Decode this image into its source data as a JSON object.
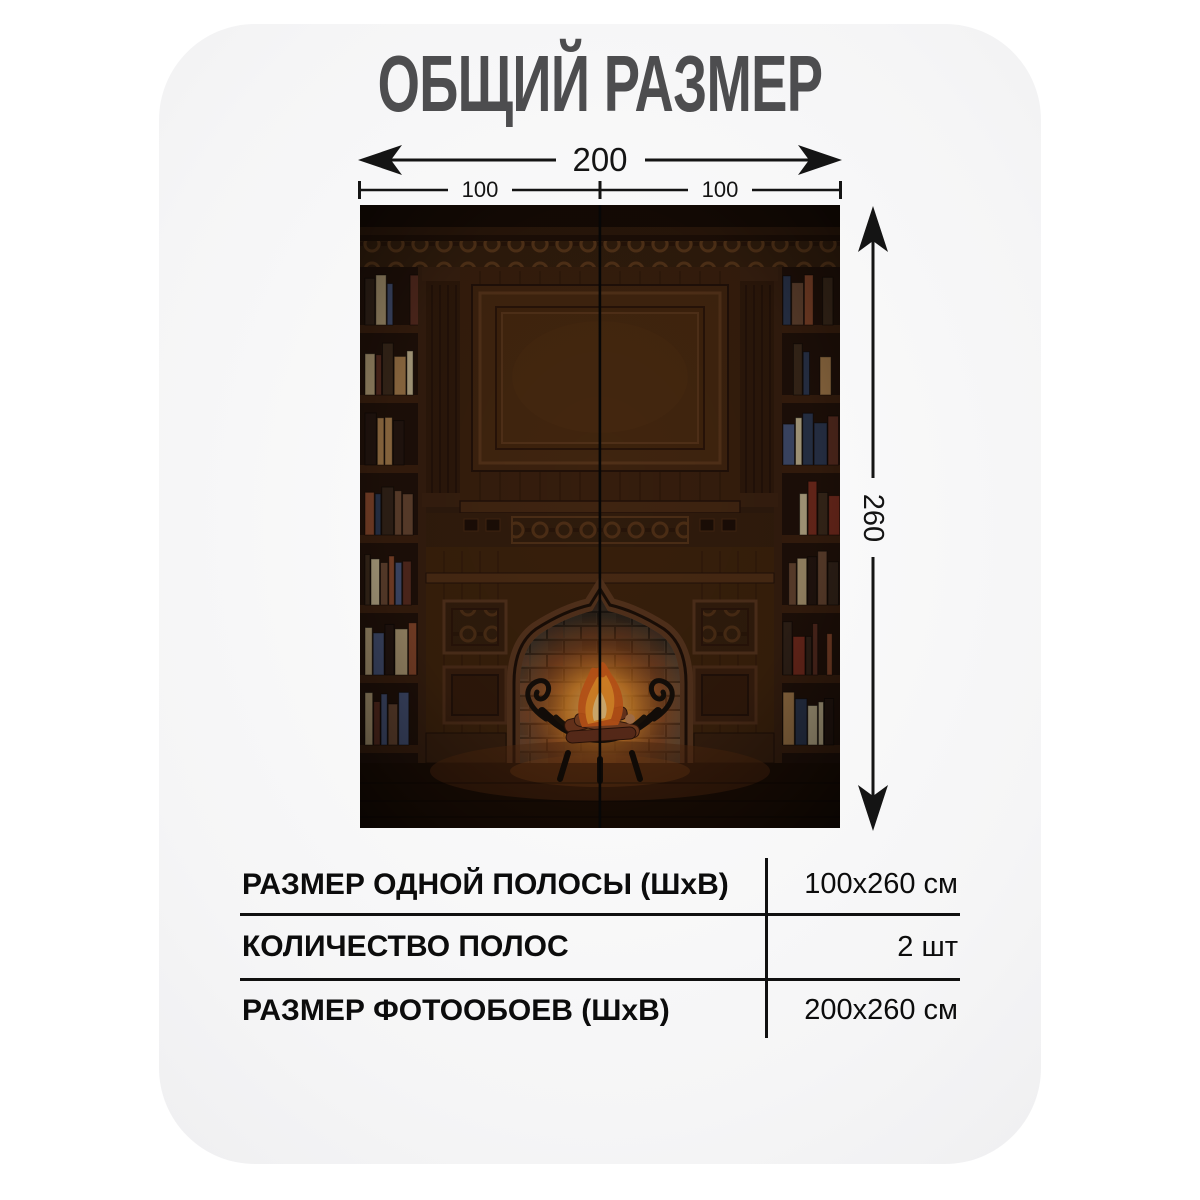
{
  "title": "ОБЩИЙ РАЗМЕР",
  "dimension_labels": {
    "total_width": "200",
    "left_strip": "100",
    "right_strip": "100",
    "height": "260"
  },
  "size_table": {
    "rows": [
      {
        "label": "РАЗМЕР ОДНОЙ ПОЛОСЫ (ШхВ)",
        "value": "100x260 см"
      },
      {
        "label": "КОЛИЧЕСТВО ПОЛОС",
        "value": "2 шт"
      },
      {
        "label": "РАЗМЕР ФОТООБОЕВ (ШхВ)",
        "value": "200x260 см"
      }
    ]
  },
  "colors": {
    "page_background": "#ffffff",
    "card_background": "#f0f0f1",
    "title_text": "#4d4d4f",
    "dimension_lines": "#141414",
    "table_text": "#0c0c0c",
    "photo_wood_dark": "#331e10",
    "photo_fire_orange": "#ff9d2e"
  }
}
